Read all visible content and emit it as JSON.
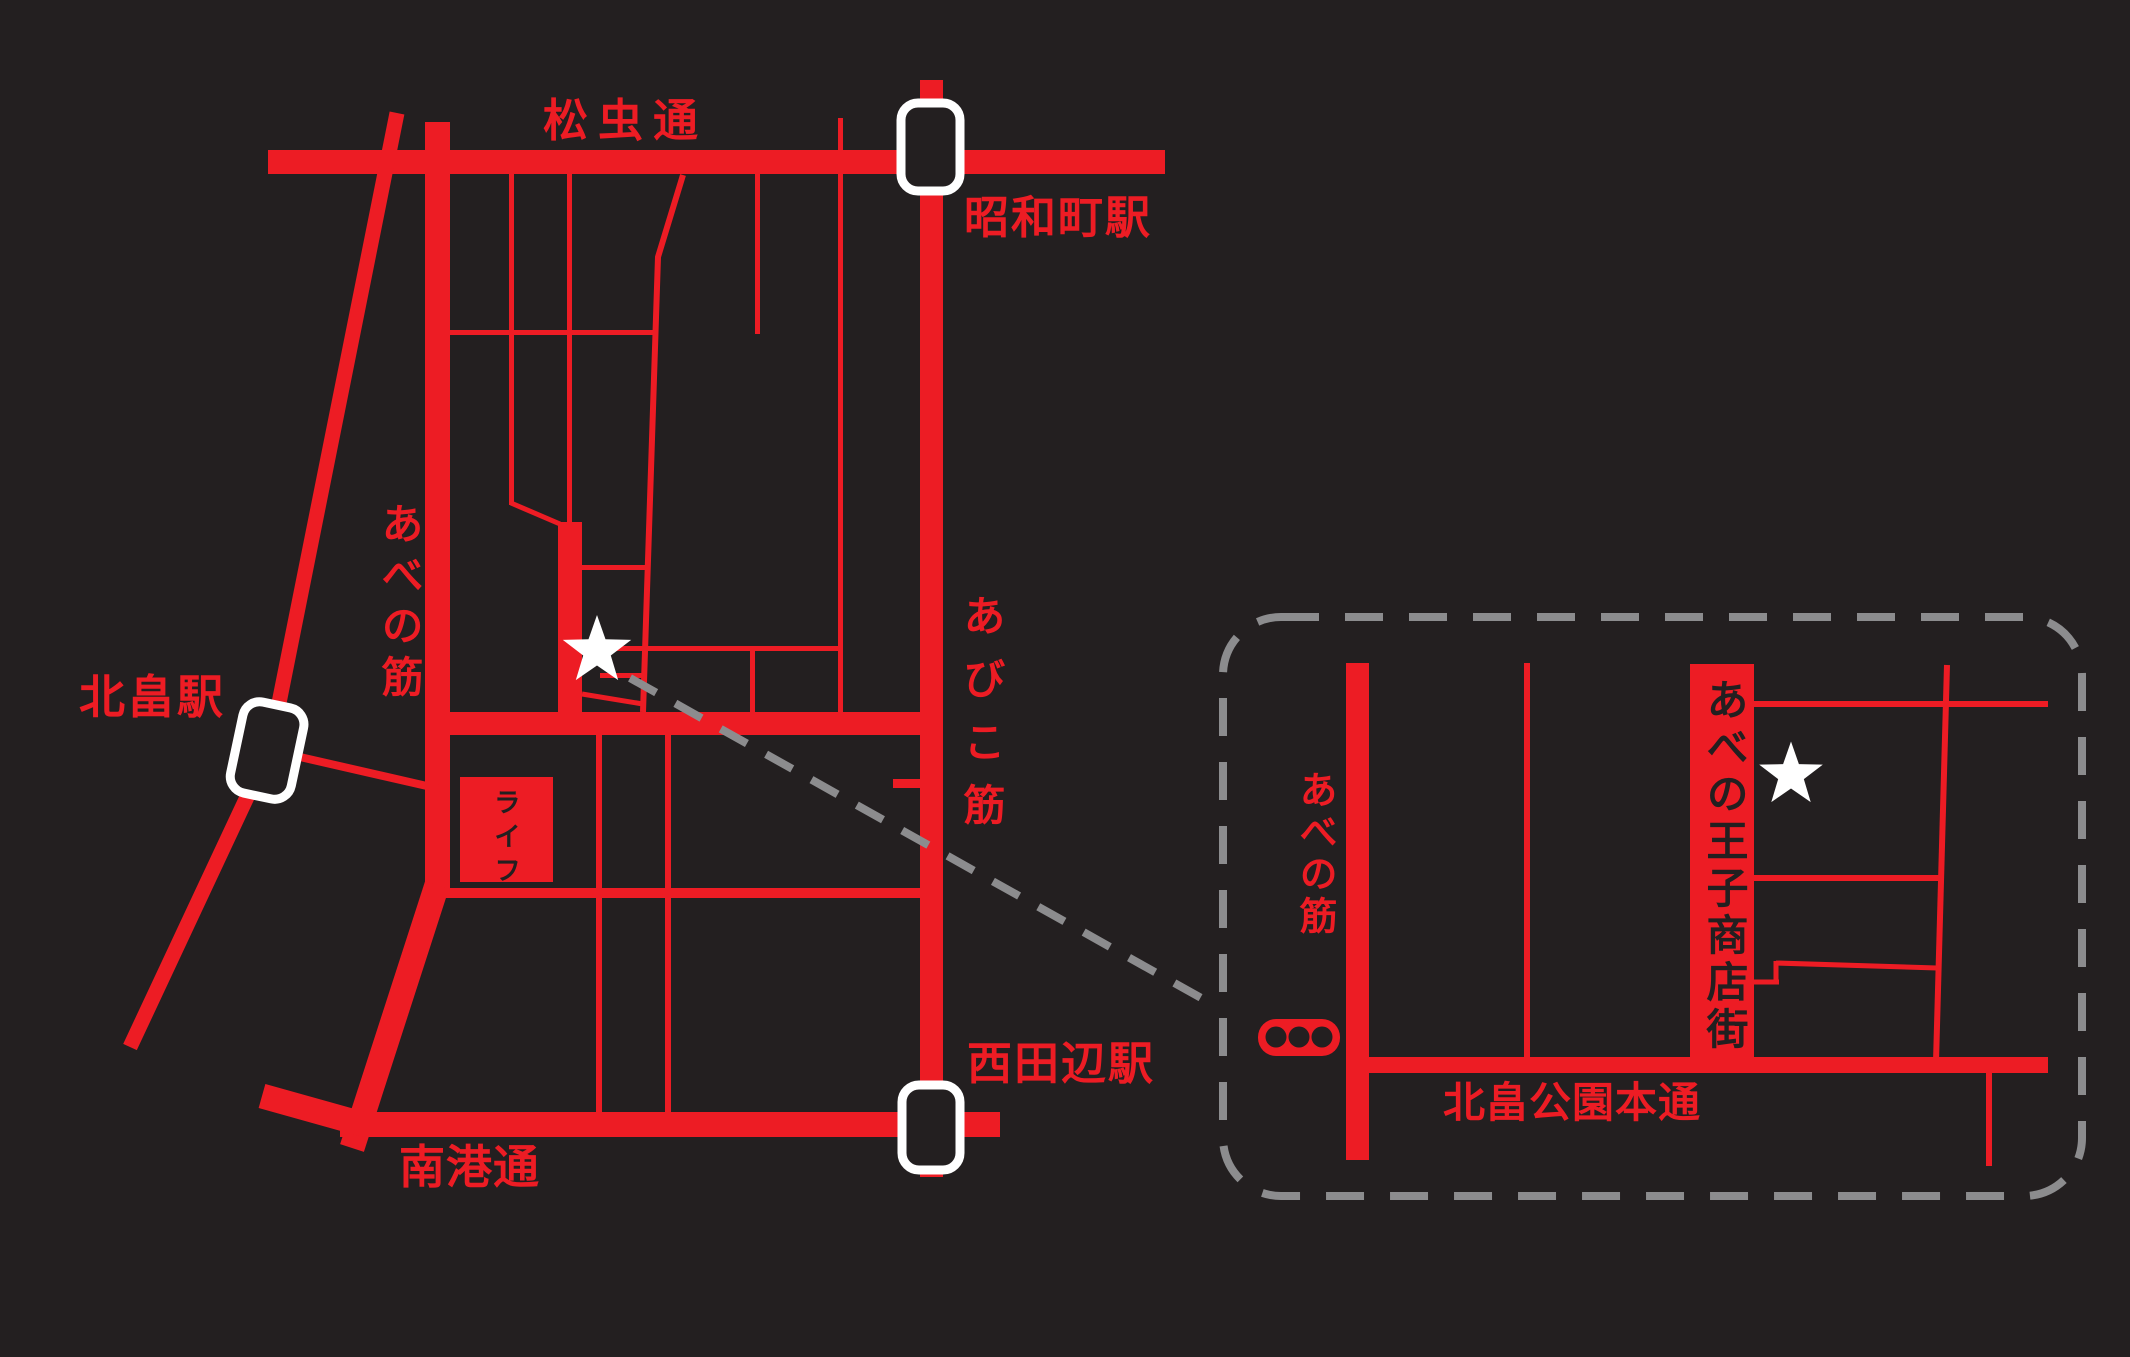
{
  "colors": {
    "background": "#231f20",
    "road_red": "#ed1c24",
    "dash_gray": "#8c8c8e",
    "star_white": "#ffffff",
    "text_on_red": "#231f20"
  },
  "main_map": {
    "labels": {
      "matsumushi_dori": "松虫通",
      "showacho_station": "昭和町駅",
      "abiko_suji": "あびこ筋",
      "abeno_suji": "あべの筋",
      "kitabatake_station": "北畠駅",
      "life_store": "ライフ",
      "nanko_dori": "南港通",
      "nishitanabe_station": "西田辺駅"
    },
    "icons": {
      "station_marker": "white-rounded-rectangle",
      "destination_star": "white-star"
    }
  },
  "inset_map": {
    "labels": {
      "abeno_suji": "あべの筋",
      "oji_shotengai": "あべの王子商店街",
      "kitabatake_koen_hondori": "北畠公園本通"
    },
    "icons": {
      "traffic_light": "three-dot-signal",
      "destination_star": "white-star"
    }
  }
}
